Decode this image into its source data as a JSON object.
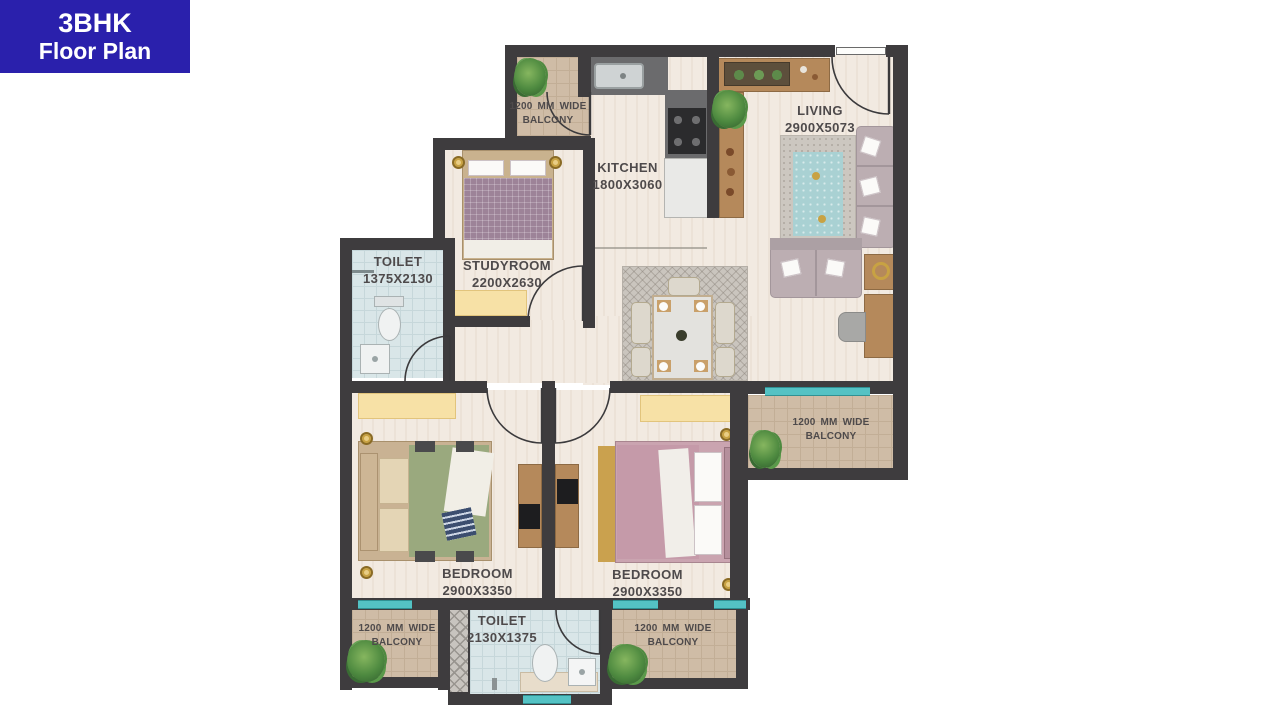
{
  "badge": {
    "title": "3BHK",
    "subtitle": "Floor Plan"
  },
  "rooms": {
    "kitchen": {
      "name": "KITCHEN",
      "dims": "1800X3060"
    },
    "living": {
      "name": "LIVING",
      "dims": "2900X5073"
    },
    "studyroom": {
      "name": "STUDYROOM",
      "dims": "2200X2630"
    },
    "toilet_upper": {
      "name": "TOILET",
      "dims": "1375X2130"
    },
    "bedroom_left": {
      "name": "BEDROOM",
      "dims": "2900X3350"
    },
    "bedroom_right": {
      "name": "BEDROOM",
      "dims": "2900X3350"
    },
    "toilet_lower": {
      "name": "TOILET",
      "dims": "2130X1375"
    }
  },
  "balconies": {
    "top_left": {
      "line1": "1200 MM WIDE",
      "line2": "BALCONY"
    },
    "mid_right": {
      "line1": "1200 MM WIDE",
      "line2": "BALCONY"
    },
    "bottom_left": {
      "line1": "1200 MM WIDE",
      "line2": "BALCONY"
    },
    "bottom_right": {
      "line1": "1200 MM WIDE",
      "line2": "BALCONY"
    }
  },
  "colors": {
    "badge_bg": "#2a20ac",
    "badge_fg": "#ffffff",
    "wall": "#3e3c3e",
    "floor": "#f1e8de",
    "balcony_floor": "#cfbca6",
    "toilet_floor": "#d9e6e8",
    "window_accent": "#54c2c4",
    "wardrobe": "#f7e1a6",
    "label_text": "#4e4a4b",
    "wood": "#b5895b",
    "sofa": "#bcaeb2",
    "bed_green": "#9aa97e",
    "bed_pink": "#c59aa9",
    "bed_mauve": "#9d8398",
    "gold": "#c8a243"
  }
}
